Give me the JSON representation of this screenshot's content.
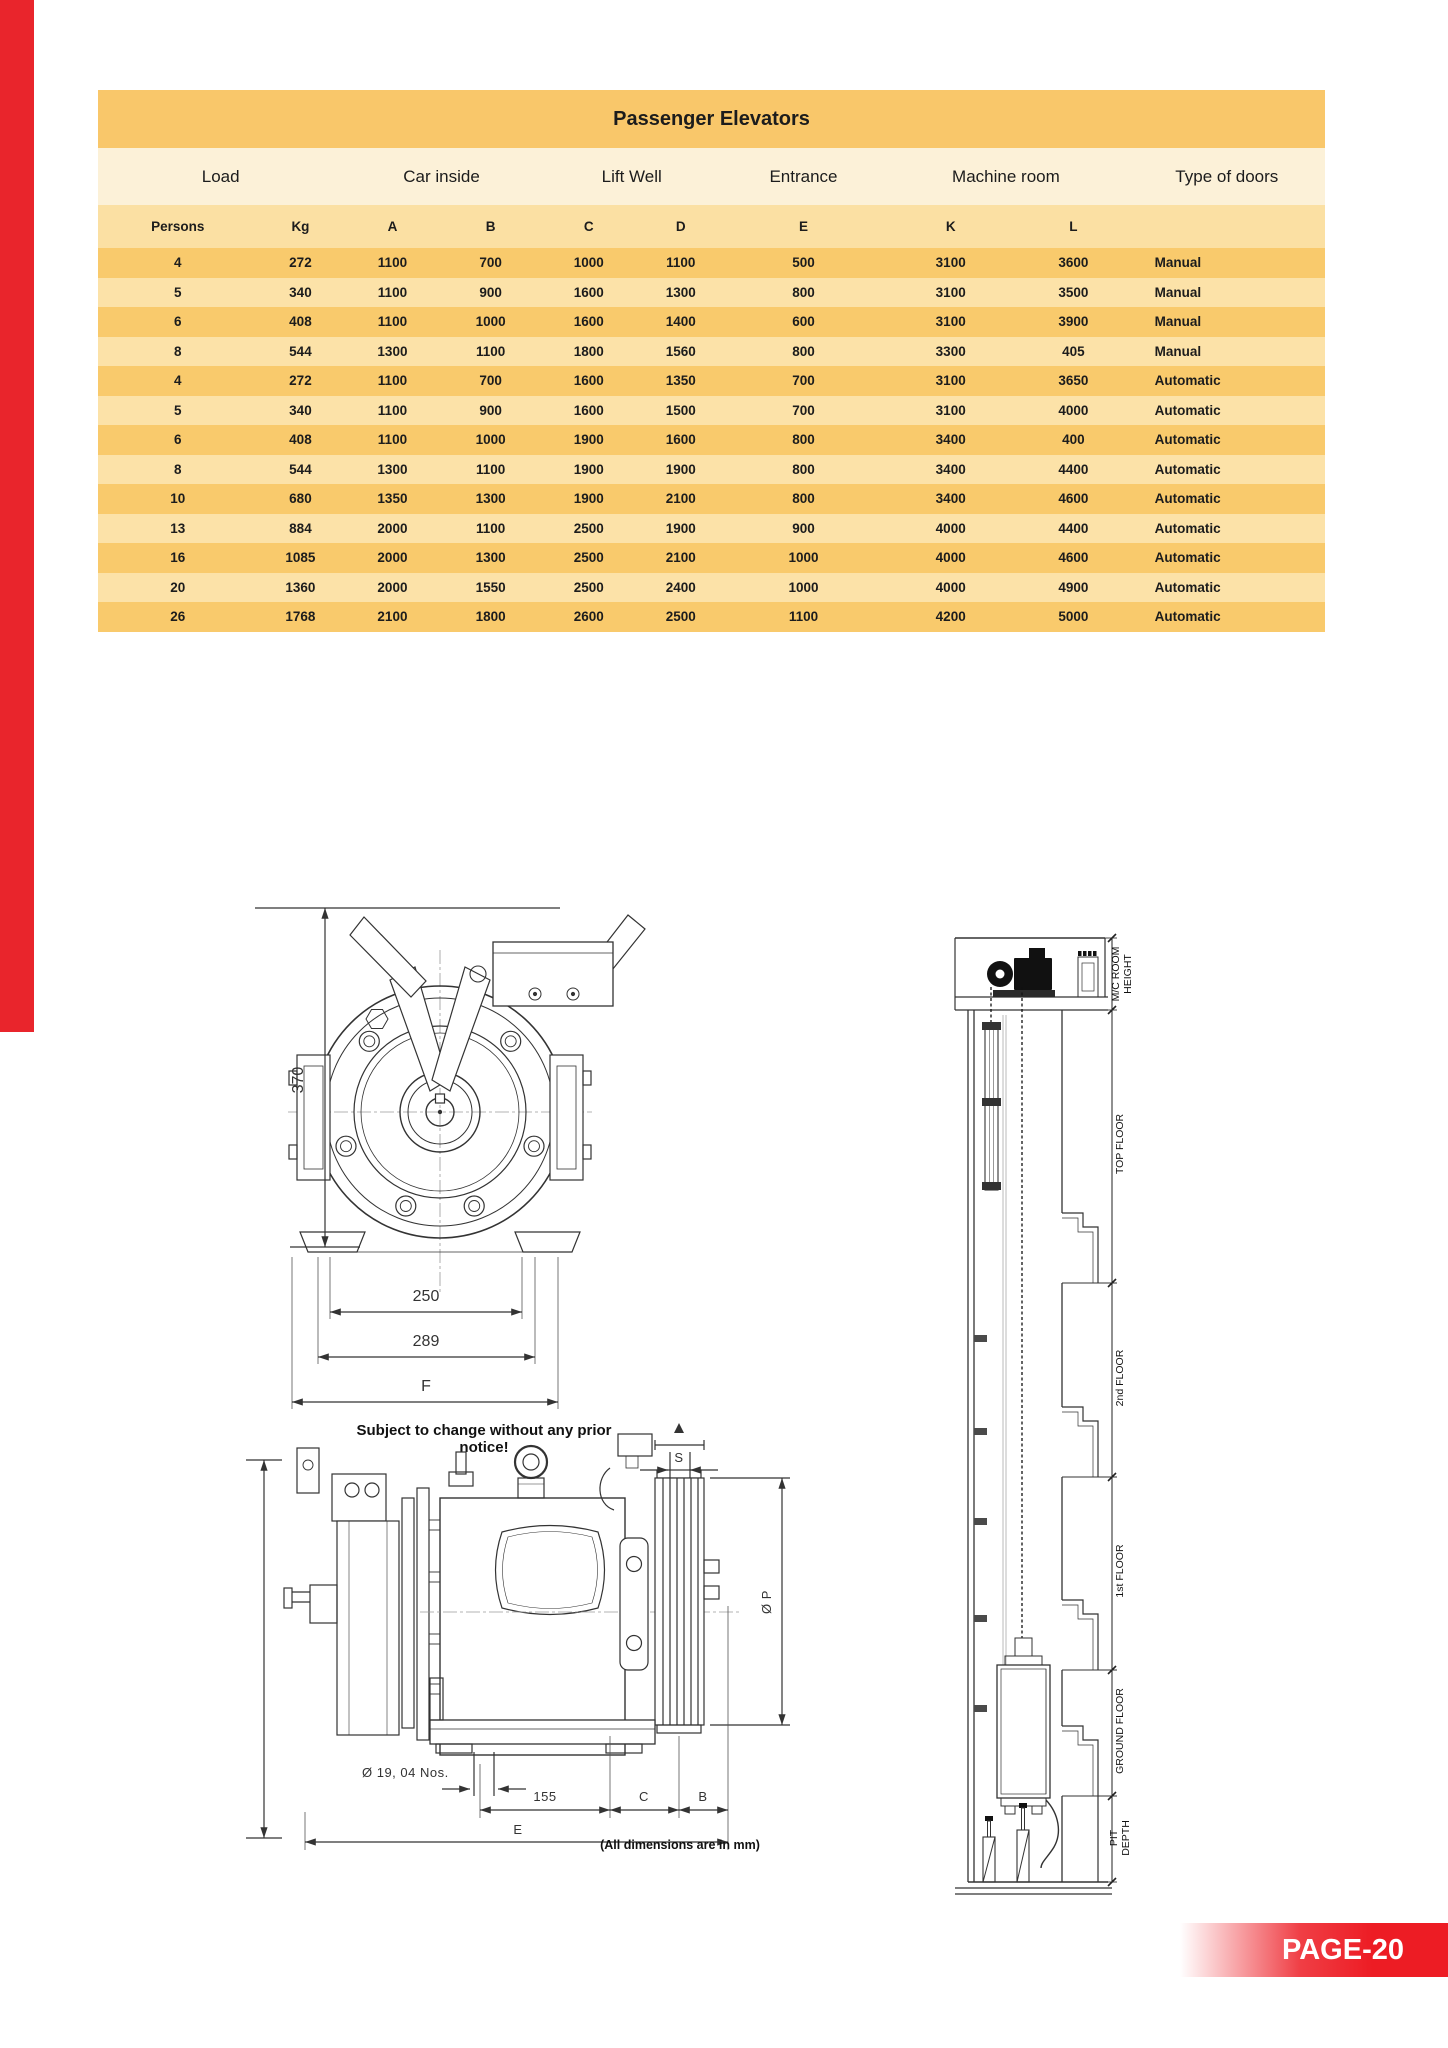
{
  "page": {
    "accent_bar_color": "#E9252C",
    "banner": {
      "label": "PAGE-20",
      "color": "#ED1C24",
      "text_color": "#FFFFFF"
    }
  },
  "table": {
    "title": "Passenger Elevators",
    "colors": {
      "title_bg": "#F9C76A",
      "group_bg": "#FCF1D8",
      "subhead_bg": "#FBE0A3",
      "row_dark": "#F9CA6C",
      "row_light": "#FCE2A8",
      "text": "#1C1C1C"
    },
    "groups": [
      {
        "label": "Load",
        "span": 2
      },
      {
        "label": "Car inside",
        "span": 2
      },
      {
        "label": "Lift Well",
        "span": 2
      },
      {
        "label": "Entrance",
        "span": 1
      },
      {
        "label": "Machine room",
        "span": 2
      },
      {
        "label": "Type of doors",
        "span": 1
      }
    ],
    "columns": [
      "Persons",
      "Kg",
      "A",
      "B",
      "C",
      "D",
      "E",
      "K",
      "L",
      ""
    ],
    "rows": [
      [
        "4",
        "272",
        "1100",
        "700",
        "1000",
        "1100",
        "500",
        "3100",
        "3600",
        "Manual"
      ],
      [
        "5",
        "340",
        "1100",
        "900",
        "1600",
        "1300",
        "800",
        "3100",
        "3500",
        "Manual"
      ],
      [
        "6",
        "408",
        "1100",
        "1000",
        "1600",
        "1400",
        "600",
        "3100",
        "3900",
        "Manual"
      ],
      [
        "8",
        "544",
        "1300",
        "1100",
        "1800",
        "1560",
        "800",
        "3300",
        "405",
        "Manual"
      ],
      [
        "4",
        "272",
        "1100",
        "700",
        "1600",
        "1350",
        "700",
        "3100",
        "3650",
        "Automatic"
      ],
      [
        "5",
        "340",
        "1100",
        "900",
        "1600",
        "1500",
        "700",
        "3100",
        "4000",
        "Automatic"
      ],
      [
        "6",
        "408",
        "1100",
        "1000",
        "1900",
        "1600",
        "800",
        "3400",
        "400",
        "Automatic"
      ],
      [
        "8",
        "544",
        "1300",
        "1100",
        "1900",
        "1900",
        "800",
        "3400",
        "4400",
        "Automatic"
      ],
      [
        "10",
        "680",
        "1350",
        "1300",
        "1900",
        "2100",
        "800",
        "3400",
        "4600",
        "Automatic"
      ],
      [
        "13",
        "884",
        "2000",
        "1100",
        "2500",
        "1900",
        "900",
        "4000",
        "4400",
        "Automatic"
      ],
      [
        "16",
        "1085",
        "2000",
        "1300",
        "2500",
        "2100",
        "1000",
        "4000",
        "4600",
        "Automatic"
      ],
      [
        "20",
        "1360",
        "2000",
        "1550",
        "2500",
        "2400",
        "1000",
        "4000",
        "4900",
        "Automatic"
      ],
      [
        "26",
        "1768",
        "2100",
        "1800",
        "2600",
        "2500",
        "1100",
        "4200",
        "5000",
        "Automatic"
      ]
    ]
  },
  "drawings": {
    "front_view": {
      "height_dim": "370",
      "dim_250": "250",
      "dim_289": "289",
      "dim_f": "F",
      "note": "Subject to change without any prior notice!"
    },
    "side_view": {
      "dim_s": "S",
      "dim_p": "Ø P",
      "holes_label": "Ø 19, 04 Nos.",
      "dim_155": "155",
      "dim_c": "C",
      "dim_b": "B",
      "dim_e": "E",
      "units_note": "(All dimensions are in mm)"
    },
    "shaft_view": {
      "machine_room_line1": "M/C ROOM",
      "machine_room_line2": "HEIGHT",
      "top_floor": "TOP FLOOR",
      "second_floor": "2nd FLOOR",
      "first_floor": "1st FLOOR",
      "ground_floor": "GROUND FLOOR",
      "pit_line1": "PIT",
      "pit_line2": "DEPTH"
    }
  }
}
